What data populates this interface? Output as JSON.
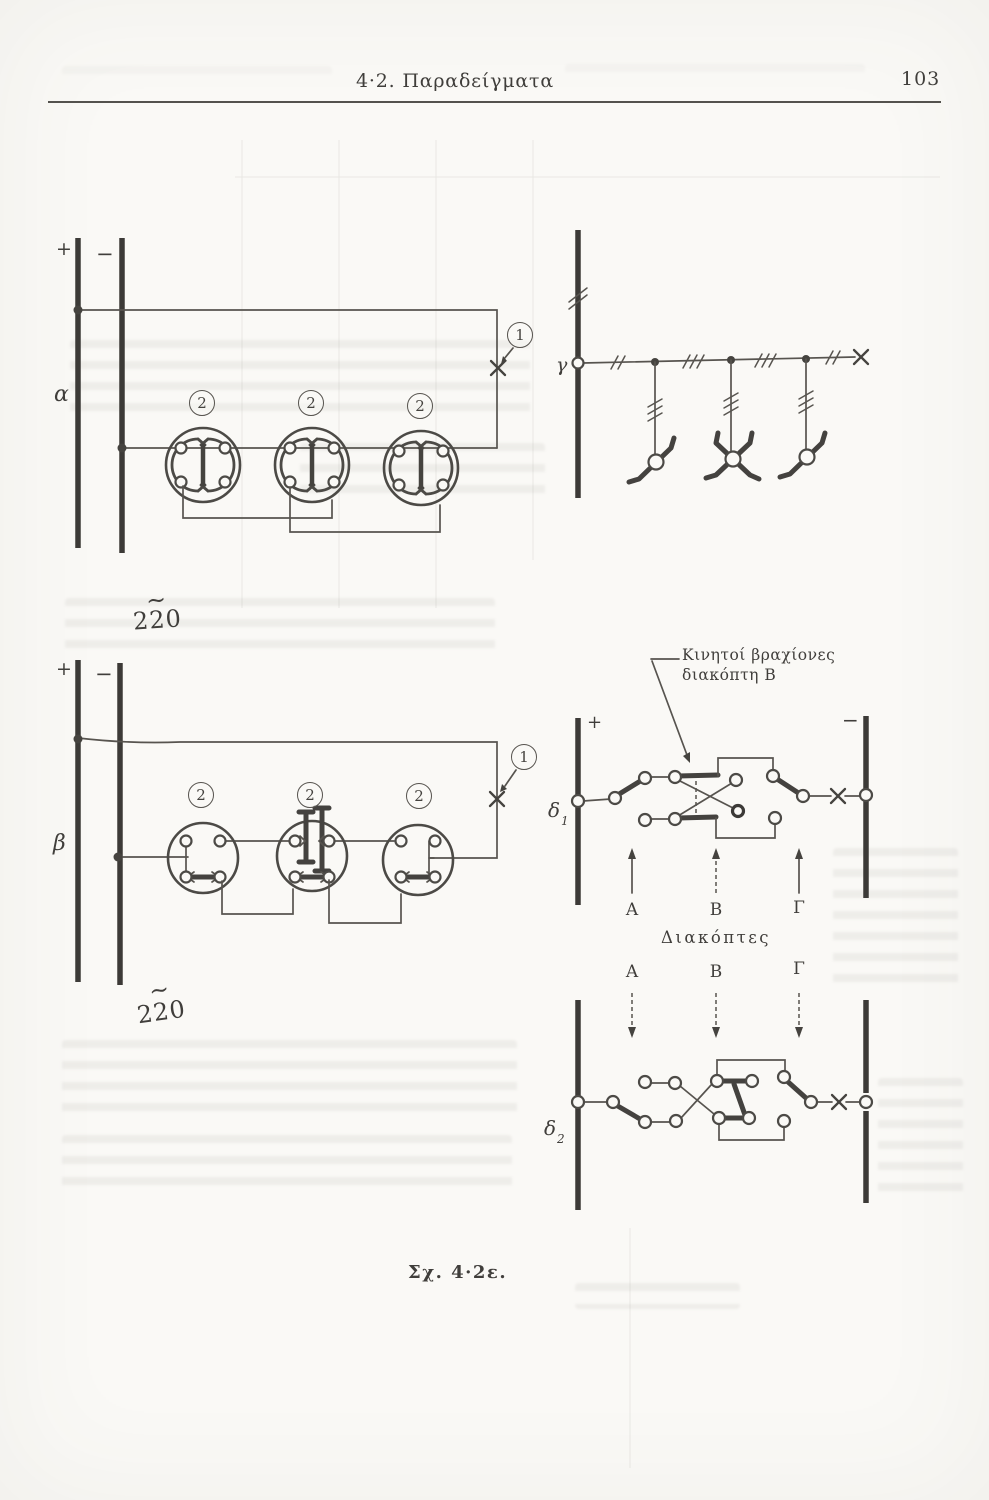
{
  "header": {
    "section_title": "4·2. Παραδείγματα",
    "page_number": "103"
  },
  "figure": {
    "caption": "Σχ. 4·2ε.",
    "supply_voltage": "220",
    "ac_tilde": "∼",
    "plus": "+",
    "minus": "−",
    "callouts": {
      "switch": "1",
      "lamp": "2"
    },
    "circuit_labels": {
      "alpha": "α",
      "beta": "β",
      "gamma": "γ",
      "delta": "δ",
      "delta1_sub": "1",
      "delta2_sub": "2"
    },
    "switch_columns": {
      "a": "A",
      "b": "B",
      "g": "Γ"
    },
    "switches_title": "Διακόπτες",
    "annotation": {
      "line1": "Κινητοί βραχίονες",
      "line2": "διακόπτη  Β"
    }
  }
}
